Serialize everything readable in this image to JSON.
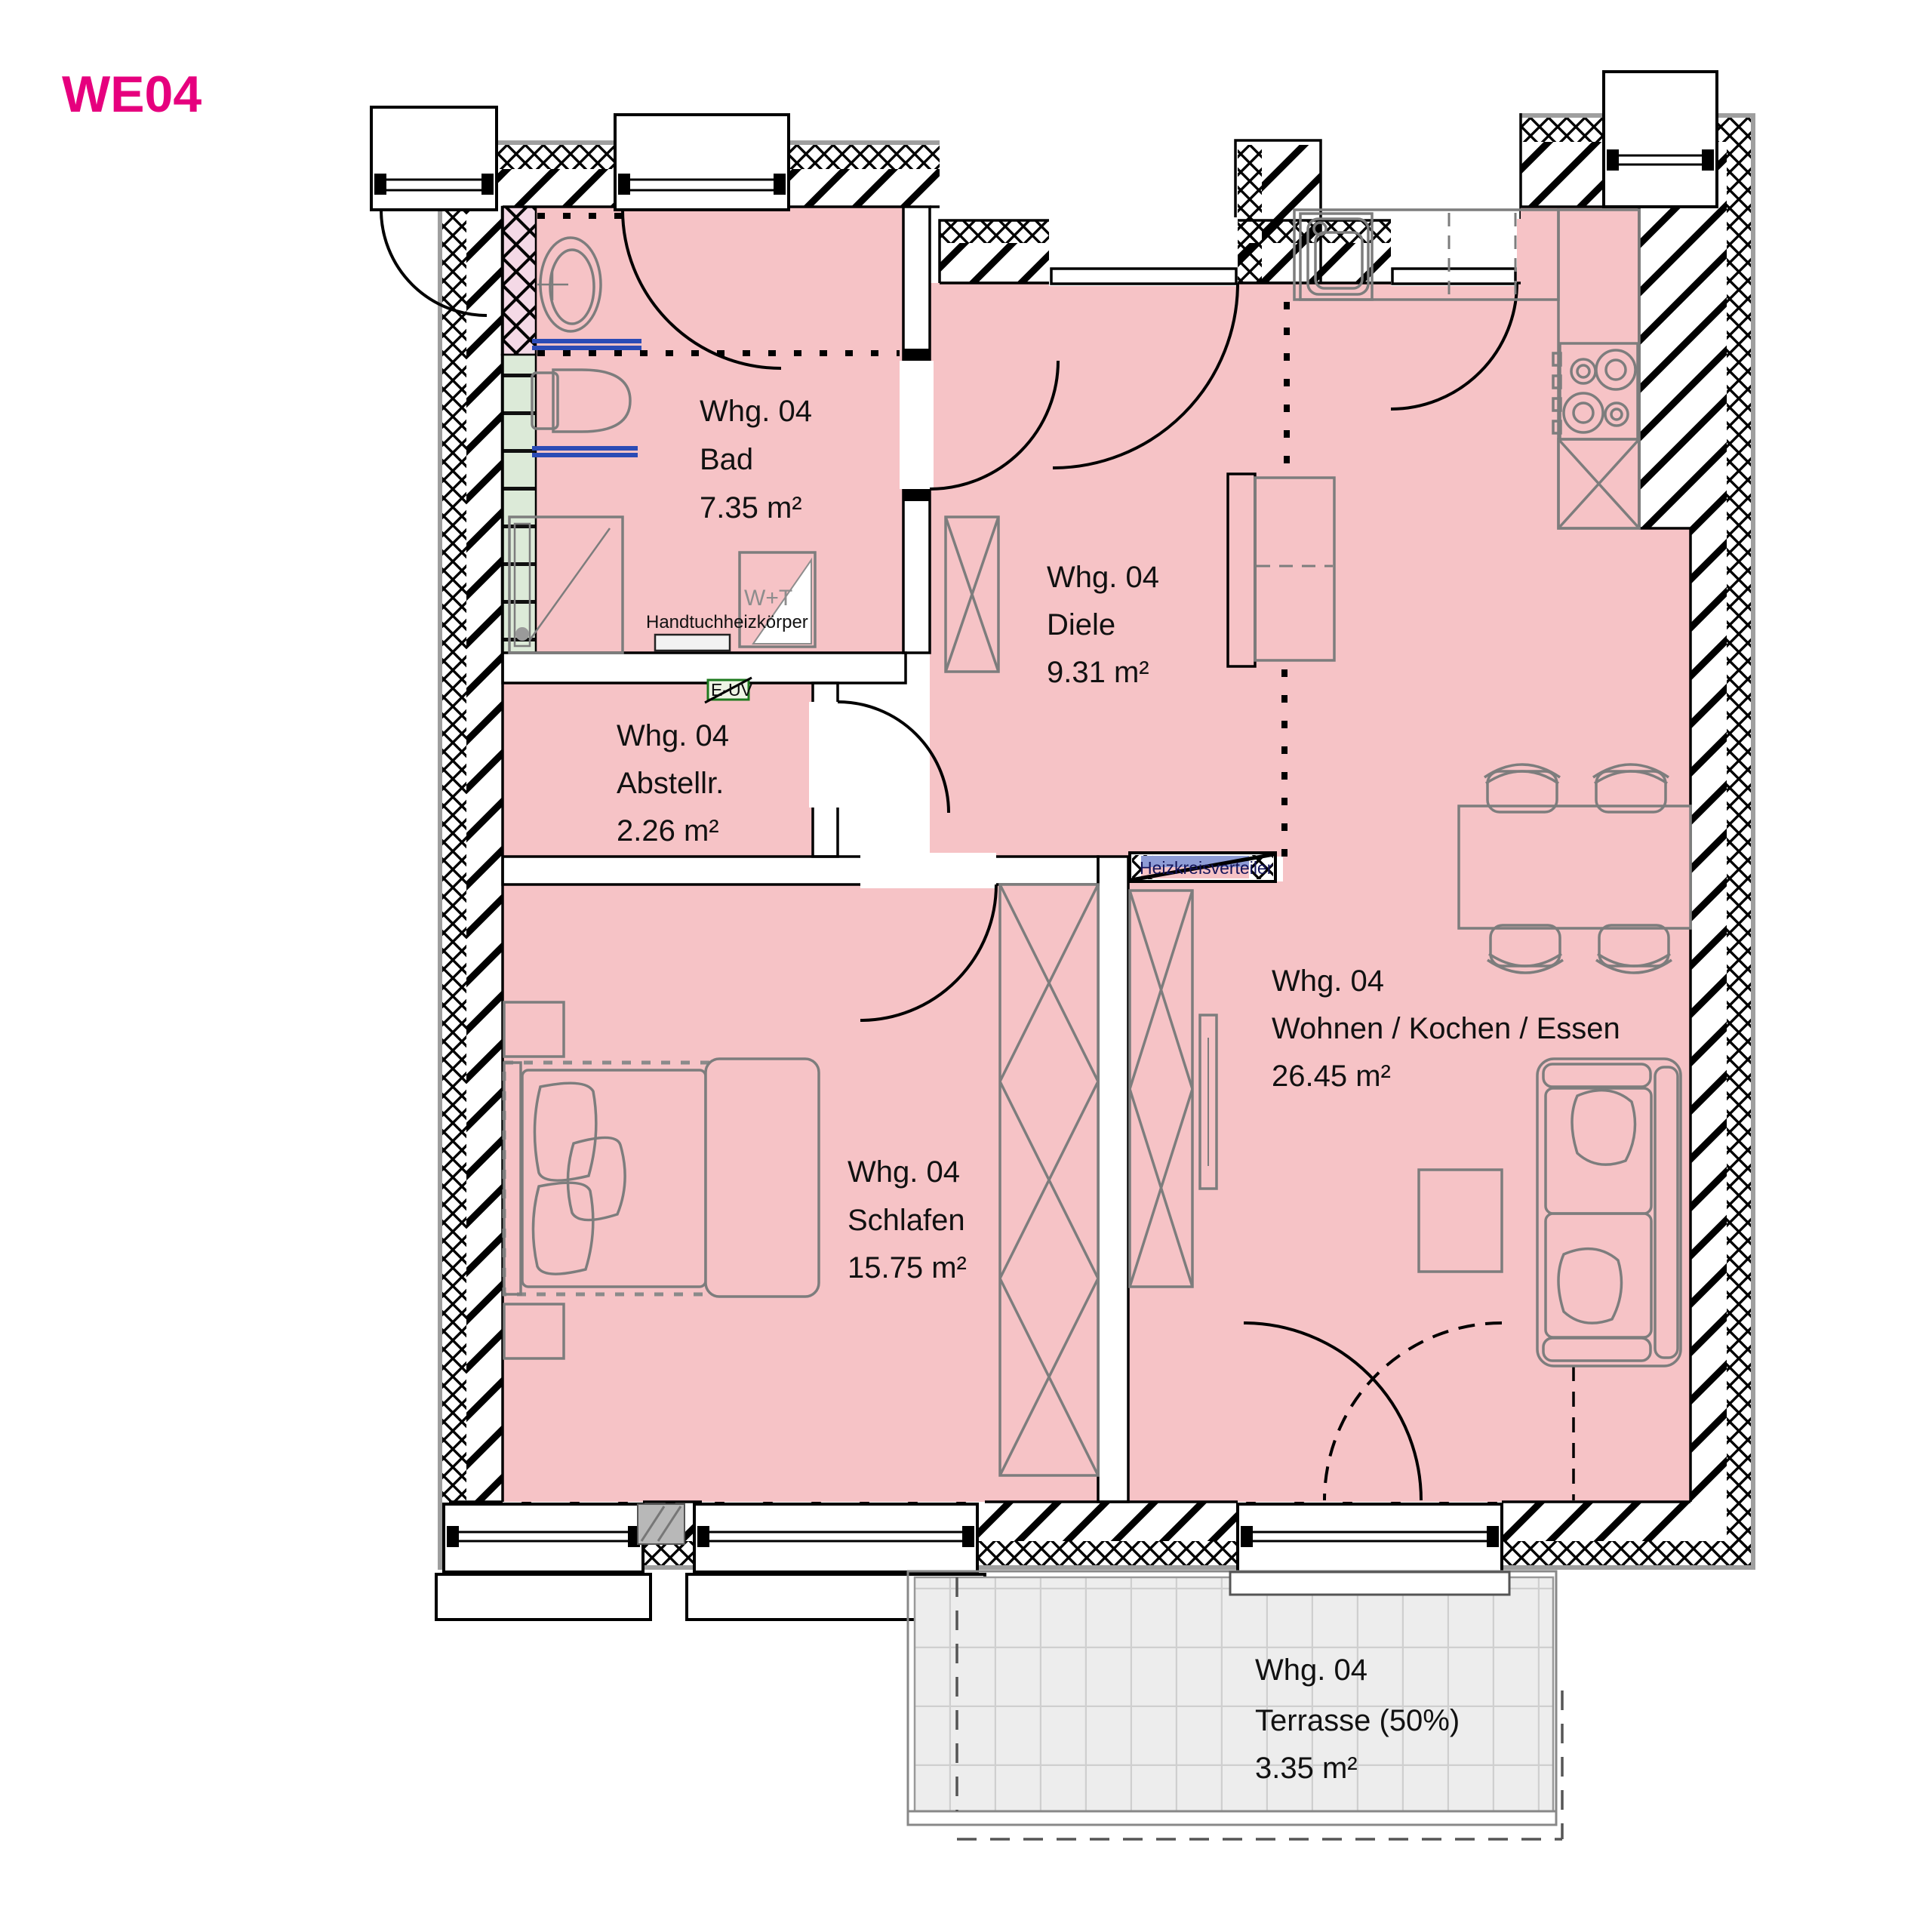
{
  "plan_title": "WE04",
  "unit_header": {
    "name": "WE 04",
    "area": "64.47 m²"
  },
  "rooms": [
    {
      "id": "bad",
      "unit": "Whg. 04",
      "name": "Bad",
      "area": "7.35 m²"
    },
    {
      "id": "diele",
      "unit": "Whg. 04",
      "name": "Diele",
      "area": "9.31 m²"
    },
    {
      "id": "abstellraum",
      "unit": "Whg. 04",
      "name": "Abstellr.",
      "area": "2.26 m²"
    },
    {
      "id": "schlafen",
      "unit": "Whg. 04",
      "name": "Schlafen",
      "area": "15.75 m²"
    },
    {
      "id": "wohnen",
      "unit": "Whg. 04",
      "name": "Wohnen / Kochen / Essen",
      "area": "26.45 m²"
    },
    {
      "id": "terrasse",
      "unit": "Whg. 04",
      "name": "Terrasse (50%)",
      "area": "3.35 m²"
    }
  ],
  "annotations": {
    "towel_radiator": "Handtuchheizkörper",
    "washer_dryer": "W+T",
    "sub_distribution": "E-UV",
    "heating_manifold": "Heizkreisverteiler"
  },
  "colors": {
    "accent": "#e6007e",
    "room_fill": "#f6c3c6",
    "prewall_pink": "#f4d9e6",
    "tile_green": "#dcead8",
    "terrace_fill": "#ededed",
    "radiator_blue": "#2b4bb5"
  }
}
